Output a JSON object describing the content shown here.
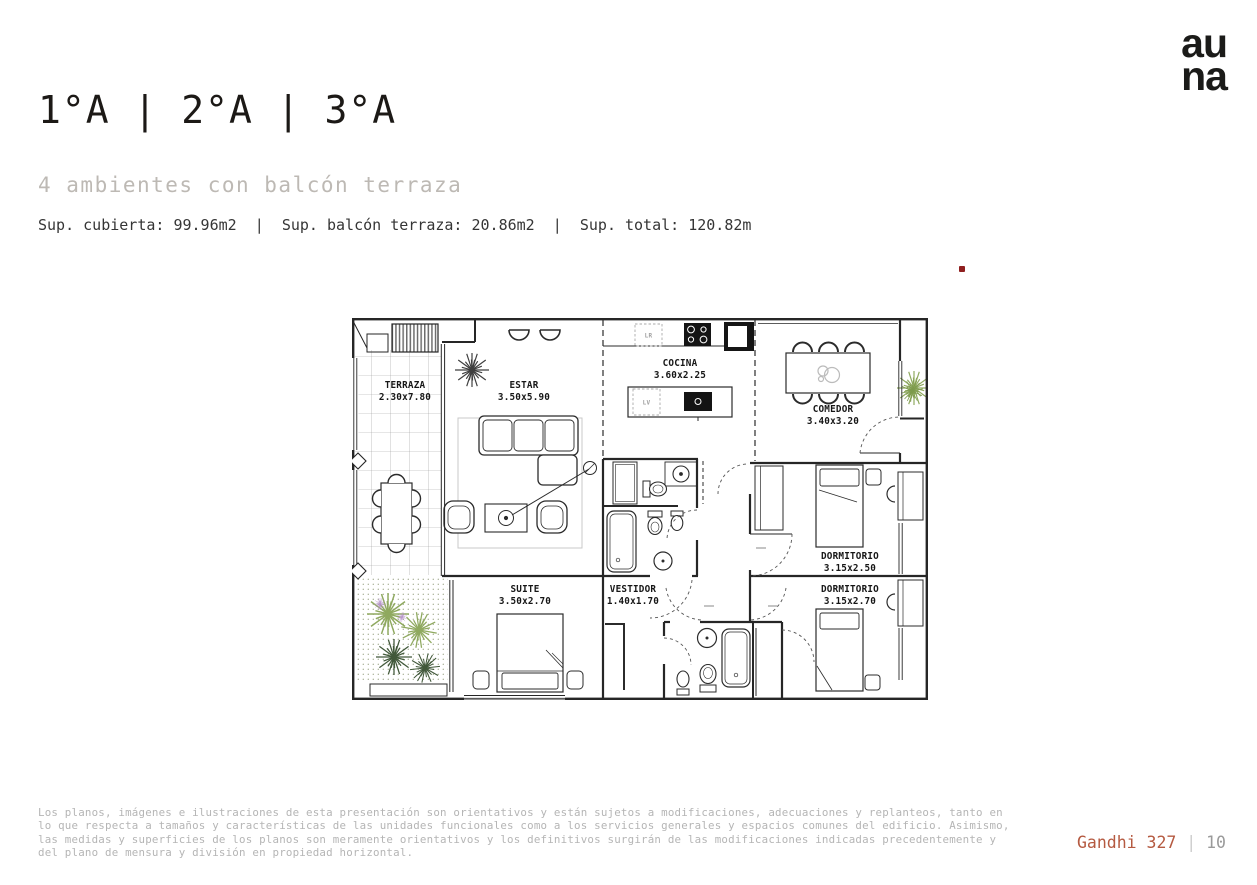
{
  "header": {
    "title": "1°A | 2°A | 3°A",
    "subtitle": "4 ambientes con balcón terraza",
    "surface_line": "Sup. cubierta: 99.96m2  |  Sup. balcón terraza: 20.86m2  |  Sup. total: 120.82m"
  },
  "logo": {
    "top": "au",
    "bottom": "na"
  },
  "plan": {
    "rooms": [
      {
        "name": "TERRAZA",
        "dims": "2.30x7.80"
      },
      {
        "name": "ESTAR",
        "dims": "3.50x5.90"
      },
      {
        "name": "COCINA",
        "dims": "3.60x2.25"
      },
      {
        "name": "COMEDOR",
        "dims": "3.40x3.20"
      },
      {
        "name": "DORMITORIO",
        "dims": "3.15x2.50"
      },
      {
        "name": "DORMITORIO",
        "dims": "3.15x2.70"
      },
      {
        "name": "SUITE",
        "dims": "3.50x2.70"
      },
      {
        "name": "VESTIDOR",
        "dims": "1.40x1.70"
      }
    ],
    "appliances": [
      {
        "label": "LR"
      },
      {
        "label": "LV"
      }
    ]
  },
  "footer": {
    "disclaimer_lines": [
      "Los planos, imágenes e ilustraciones de esta presentación son orientativos y están sujetos a modificaciones, adecuaciones y replanteos, tanto en",
      "lo que respecta a tamaños y características de las unidades funcionales como a los servicios generales y espacios comunes del edificio. Asimismo,",
      "las medidas y superficies de los planos son meramente orientativos y los definitivos surgirán de las modificaciones indicadas precedentemente y",
      "del plano de mensura y división en propiedad horizontal."
    ],
    "project_name": "Gandhi 327",
    "separator": "|",
    "page_number": "10"
  },
  "colors": {
    "accent_terracotta": "#b55a41",
    "marker_dot": "#8f1f1f",
    "wall": "#262626",
    "plant_light": "#8fa95f",
    "plant_mid": "#7c9a4b",
    "plant_dark": "#41583a",
    "plant_gray": "#3f3f3f",
    "flower_purple": "#b48fc8",
    "muted_text": "#b5b5b5"
  }
}
